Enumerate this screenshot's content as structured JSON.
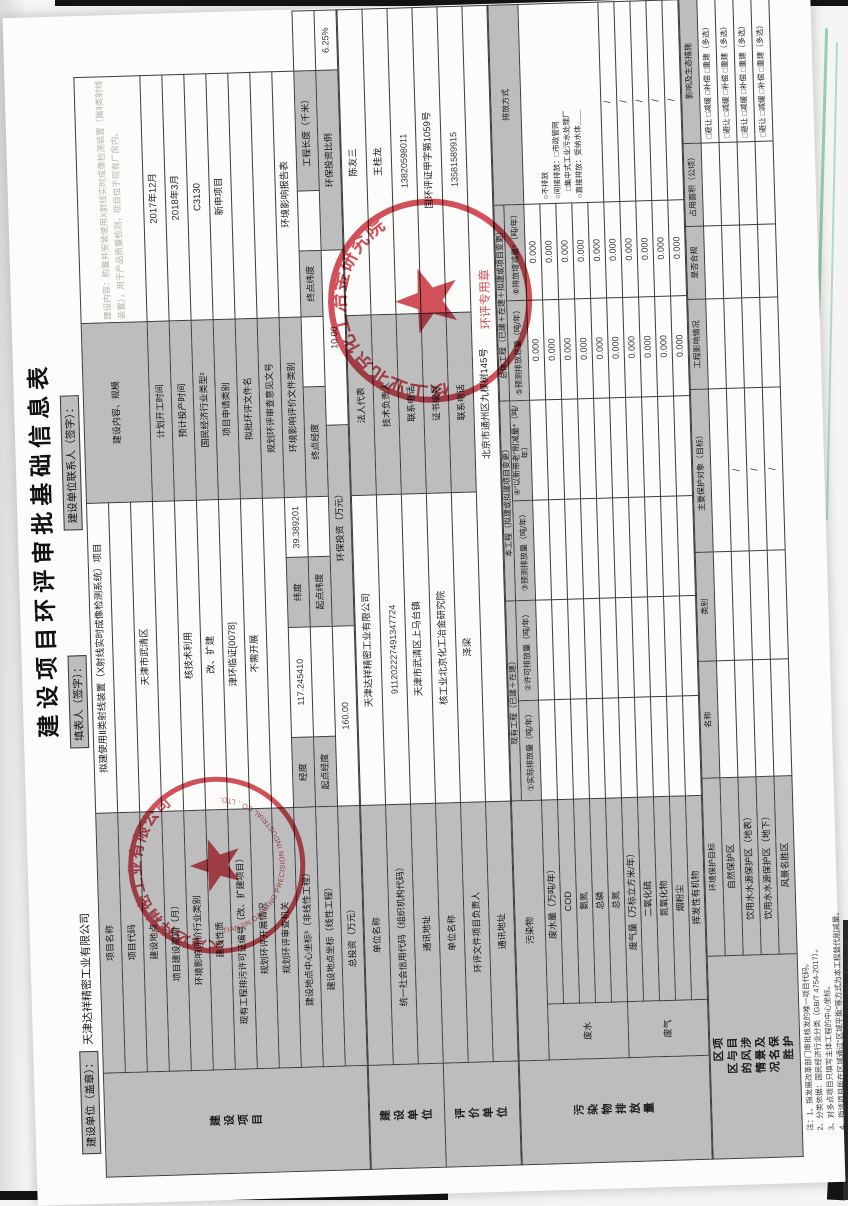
{
  "page": {
    "title": "建设项目环评审批基础信息表"
  },
  "header": {
    "unit_label": "建设单位（盖章）：",
    "unit_value": "天津达祥精密工业有限公司",
    "filler_label": "填表人（签字）：",
    "contact_label": "建设单位联系人（签字）："
  },
  "stamps": {
    "company": {
      "zh": "天津达祥精密工业有限公司",
      "en": "TIANJIN DAXIANG PRECISION INDUSTRIAL CO., LTD."
    },
    "eia": {
      "zh": "核工业北京化工冶金研究院",
      "sub": "环评专用章"
    }
  },
  "notes": {
    "lines": [
      "注：1、指发展改革部门审批核发的唯一项目代码。",
      "2、分类依据：国民经济行业分类（GB/T 4754-2017）。",
      "3、对多点项目只填写主体工程的中心坐标。",
      "4、指该项目所在区域通过“区域平衡”等方式为本工程替代削减量。",
      "5、⑤＝①＋③－④，⑥＝⑤－②；当②＝0时，⑥＝⑤－①。"
    ]
  },
  "tables": {
    "t1": {
      "cols": [
        104,
        260,
        70,
        110,
        70,
        60,
        71,
        39,
        70,
        66,
        60,
        90,
        30,
        60
      ],
      "rows": [
        [
          {
            "t": "建设项目",
            "k": "sec",
            "rs": 12,
            "n": "section-construction-project"
          },
          {
            "t": "项目名称",
            "k": "lab"
          },
          {
            "t": "拟建使用Ⅱ类射线装置（X射线实时成像检测系统）项目",
            "k": "val",
            "cs": 4,
            "n": "project-name-value"
          },
          {
            "t": "建设内容、规模",
            "k": "lab",
            "cs": 3,
            "rs": 3
          },
          {
            "t": "建设内容：购置并安装使用X射线实时成像检测装置（属Ⅱ类射线装置），用于产品质量检测，项目位于现有厂房内。",
            "k": "faint",
            "cs": 4,
            "rs": 3,
            "n": "construction-content-value"
          }
        ],
        [
          {
            "t": "项目代码",
            "k": "lab"
          },
          {
            "t": "",
            "k": "val",
            "cs": 4
          }
        ],
        [
          {
            "t": "建设地点",
            "k": "lab"
          },
          {
            "t": "天津市武清区",
            "k": "val",
            "cs": 4,
            "n": "construction-site-value"
          }
        ],
        [
          {
            "t": "项目建设周期（月）",
            "k": "lab"
          },
          {
            "t": "",
            "k": "val",
            "cs": 4
          },
          {
            "t": "计划开工时间",
            "k": "lab",
            "cs": 3
          },
          {
            "t": "2017年12月",
            "k": "val",
            "cs": 4,
            "n": "planned-start-value"
          }
        ],
        [
          {
            "t": "环境影响评价行业类别",
            "k": "lab"
          },
          {
            "t": "核技术利用",
            "k": "val",
            "cs": 4
          },
          {
            "t": "预计投产时间",
            "k": "lab",
            "cs": 3
          },
          {
            "t": "2018年3月",
            "k": "val",
            "cs": 4,
            "n": "planned-operation-value"
          }
        ],
        [
          {
            "t": "建设性质",
            "k": "lab"
          },
          {
            "t": "改、扩建",
            "k": "val",
            "cs": 4
          },
          {
            "t": "国民经济行业类型²",
            "k": "lab",
            "cs": 3
          },
          {
            "t": "C3130",
            "k": "val",
            "cs": 4,
            "n": "industry-code-value"
          }
        ],
        [
          {
            "t": "现有工程排污许可证编号（改、扩建项目）",
            "k": "lab"
          },
          {
            "t": "津环临证[0078]",
            "k": "val",
            "cs": 4
          },
          {
            "t": "项目申请类别",
            "k": "lab",
            "cs": 3
          },
          {
            "t": "新申项目",
            "k": "val",
            "cs": 4
          }
        ],
        [
          {
            "t": "规划环评开展情况",
            "k": "lab"
          },
          {
            "t": "不需开展",
            "k": "val",
            "cs": 4
          },
          {
            "t": "拟批环评文件名",
            "k": "lab",
            "cs": 3
          },
          {
            "t": "",
            "k": "val",
            "cs": 4
          }
        ],
        [
          {
            "t": "规划环评审查机关",
            "k": "lab"
          },
          {
            "t": "",
            "k": "val",
            "cs": 4
          },
          {
            "t": "规划环评审查意见文号",
            "k": "lab",
            "cs": 3
          },
          {
            "t": "",
            "k": "val",
            "cs": 4
          }
        ],
        [
          {
            "t": "建设地点中心坐标³（非线性工程）",
            "k": "lab"
          },
          {
            "t": "经度",
            "k": "lab"
          },
          {
            "t": "117.245410",
            "k": "num",
            "n": "longitude-value"
          },
          {
            "t": "纬度",
            "k": "lab"
          },
          {
            "t": "39.389201",
            "k": "num",
            "n": "latitude-value"
          },
          {
            "t": "环境影响评价文件类别",
            "k": "lab",
            "cs": 3
          },
          {
            "t": "环境影响报告表",
            "k": "val",
            "cs": 4,
            "n": "eia-doc-type-value"
          }
        ],
        [
          {
            "t": "建设地点坐标（线性工程）",
            "k": "lab"
          },
          {
            "t": "起点经度",
            "k": "lab"
          },
          {
            "t": "",
            "k": "val"
          },
          {
            "t": "起点纬度",
            "k": "lab"
          },
          {
            "t": "",
            "k": "val"
          },
          {
            "t": "终点经度",
            "k": "lab",
            "cs": 2
          },
          {
            "t": "",
            "k": "val"
          },
          {
            "t": "终点纬度",
            "k": "lab"
          },
          {
            "t": "",
            "k": "val"
          },
          {
            "t": "工程长度（千米）",
            "k": "lab",
            "cs": 2
          },
          {
            "t": "",
            "k": "val"
          }
        ],
        [
          {
            "t": "总投资（万元）",
            "k": "lab"
          },
          {
            "t": "160.00",
            "k": "num",
            "cs": 2,
            "n": "total-investment-value"
          },
          {
            "t": "环保投资（万元）",
            "k": "lab",
            "cs": 3
          },
          {
            "t": "10.00",
            "k": "num",
            "cs": 3,
            "n": "env-investment-value"
          },
          {
            "t": "环保投资比例",
            "k": "lab",
            "cs": 3
          },
          {
            "t": "6.25%",
            "k": "num",
            "cs": 2,
            "n": "env-investment-ratio-value"
          }
        ]
      ]
    },
    "t2": {
      "cols": [
        104,
        260,
        310,
        180,
        306
      ],
      "rows": [
        [
          {
            "t": "建设单位",
            "k": "sec",
            "rs": 3,
            "n": "section-construction-unit"
          },
          {
            "t": "单位名称",
            "k": "lab"
          },
          {
            "t": "天津达祥精密工业有限公司",
            "k": "val",
            "n": "builder-name-value"
          },
          {
            "t": "法人代表",
            "k": "lab"
          },
          {
            "t": "陈友三",
            "k": "val",
            "n": "legal-rep-value"
          }
        ],
        [
          {
            "t": "统一社会信用代码（组织机构代码）",
            "k": "lab"
          },
          {
            "t": "911202227491347724",
            "k": "num",
            "n": "credit-code-value"
          },
          {
            "t": "技术负责人",
            "k": "lab"
          },
          {
            "t": "王桂龙",
            "k": "val",
            "n": "tech-lead-value"
          }
        ],
        [
          {
            "t": "通讯地址",
            "k": "lab"
          },
          {
            "t": "天津市武清区上马台镇",
            "k": "val",
            "n": "builder-address-value"
          },
          {
            "t": "联系电话",
            "k": "lab"
          },
          {
            "t": "13820598011",
            "k": "num",
            "n": "builder-phone-value"
          }
        ],
        [
          {
            "t": "评价单位",
            "k": "sec",
            "rs": 3,
            "n": "section-eia-unit"
          },
          {
            "t": "单位名称",
            "k": "lab"
          },
          {
            "t": "核工业北京化工冶金研究院",
            "k": "val",
            "n": "eia-unit-name-value"
          },
          {
            "t": "证书编号",
            "k": "lab"
          },
          {
            "t": "国环评证甲字第1059号",
            "k": "val",
            "n": "eia-cert-value"
          }
        ],
        [
          {
            "t": "环评文件项目负责人",
            "k": "lab"
          },
          {
            "t": "泽梁",
            "k": "val",
            "n": "eia-lead-value"
          },
          {
            "t": "联系电话",
            "k": "lab"
          },
          {
            "t": "13581589915",
            "k": "num",
            "n": "eia-phone-value"
          }
        ],
        [
          {
            "t": "通讯地址",
            "k": "lab"
          },
          {
            "t": "北京市通州区九棵树145号",
            "k": "val",
            "cs": 3,
            "n": "eia-address-value"
          }
        ]
      ]
    },
    "t3": {
      "cols": [
        104,
        56,
        204,
        100,
        100,
        100,
        100,
        100,
        96,
        200
      ],
      "rows": [
        [
          {
            "t": "污染物排放量",
            "k": "sec",
            "rs": 12,
            "n": "section-pollutant-discharge"
          },
          {
            "t": "污染物",
            "k": "lab",
            "cs": 2,
            "rs": 2
          },
          {
            "t": "现有工程（已建＋在建）",
            "k": "hdr",
            "cs": 2
          },
          {
            "t": "本工程（拟建或拟建项目变更）",
            "k": "hdr",
            "cs": 2
          },
          {
            "t": "总体工程（已建＋在建＋拟建或项目变更）",
            "k": "hdr",
            "cs": 2
          },
          {
            "t": "排放方式",
            "k": "hdr",
            "rs": 2
          }
        ],
        [
          {
            "t": "①实际排放量（吨/年）",
            "k": "hdr"
          },
          {
            "t": "②许可排放量（吨/年）",
            "k": "hdr"
          },
          {
            "t": "③预测排放量（吨/年）",
            "k": "hdr"
          },
          {
            "t": "④“以新带老”削减量⁴（吨/年）",
            "k": "hdr"
          },
          {
            "t": "⑤预测排放总量（吨/年）",
            "k": "hdr"
          },
          {
            "t": "⑥排放增减量⁵（吨/年）",
            "k": "hdr"
          }
        ],
        [
          {
            "t": "废水",
            "k": "lab",
            "rs": 5
          },
          {
            "t": "废水量（万吨/年）",
            "k": "lab"
          },
          {
            "t": "",
            "k": "val"
          },
          {
            "t": "",
            "k": "val"
          },
          {
            "t": "",
            "k": "val"
          },
          {
            "t": "",
            "k": "val"
          },
          {
            "t": "0.000",
            "k": "num"
          },
          {
            "t": "0.000",
            "k": "num"
          },
          {
            "t": "○不排放\n○间接排放：□市政管网\n　□集中式工业污水处理厂\n○直接排放：受纳水体＿＿",
            "k": "opt",
            "rs": 5,
            "n": "wastewater-discharge-mode"
          }
        ],
        [
          {
            "t": "COD",
            "k": "lab"
          },
          {
            "t": "",
            "k": "val"
          },
          {
            "t": "",
            "k": "val"
          },
          {
            "t": "",
            "k": "val"
          },
          {
            "t": "",
            "k": "val"
          },
          {
            "t": "0.000",
            "k": "num"
          },
          {
            "t": "0.000",
            "k": "num"
          }
        ],
        [
          {
            "t": "氨氮",
            "k": "lab"
          },
          {
            "t": "",
            "k": "val"
          },
          {
            "t": "",
            "k": "val"
          },
          {
            "t": "",
            "k": "val"
          },
          {
            "t": "",
            "k": "val"
          },
          {
            "t": "0.000",
            "k": "num"
          },
          {
            "t": "0.000",
            "k": "num"
          }
        ],
        [
          {
            "t": "总磷",
            "k": "lab"
          },
          {
            "t": "",
            "k": "val"
          },
          {
            "t": "",
            "k": "val"
          },
          {
            "t": "",
            "k": "val"
          },
          {
            "t": "",
            "k": "val"
          },
          {
            "t": "0.000",
            "k": "num"
          },
          {
            "t": "0.000",
            "k": "num"
          }
        ],
        [
          {
            "t": "总氮",
            "k": "lab"
          },
          {
            "t": "",
            "k": "val"
          },
          {
            "t": "",
            "k": "val"
          },
          {
            "t": "",
            "k": "val"
          },
          {
            "t": "",
            "k": "val"
          },
          {
            "t": "0.000",
            "k": "num"
          },
          {
            "t": "0.000",
            "k": "num"
          }
        ],
        [
          {
            "t": "废气",
            "k": "lab",
            "rs": 5
          },
          {
            "t": "废气量（万标立方米/年）",
            "k": "lab"
          },
          {
            "t": "",
            "k": "val"
          },
          {
            "t": "",
            "k": "val"
          },
          {
            "t": "",
            "k": "val"
          },
          {
            "t": "",
            "k": "val"
          },
          {
            "t": "0.000",
            "k": "num"
          },
          {
            "t": "0.000",
            "k": "num"
          },
          {
            "t": "/",
            "k": "val"
          }
        ],
        [
          {
            "t": "二氧化硫",
            "k": "lab"
          },
          {
            "t": "",
            "k": "val"
          },
          {
            "t": "",
            "k": "val"
          },
          {
            "t": "",
            "k": "val"
          },
          {
            "t": "",
            "k": "val"
          },
          {
            "t": "0.000",
            "k": "num"
          },
          {
            "t": "0.000",
            "k": "num"
          },
          {
            "t": "/",
            "k": "val"
          }
        ],
        [
          {
            "t": "氮氧化物",
            "k": "lab"
          },
          {
            "t": "",
            "k": "val"
          },
          {
            "t": "",
            "k": "val"
          },
          {
            "t": "",
            "k": "val"
          },
          {
            "t": "",
            "k": "val"
          },
          {
            "t": "0.000",
            "k": "num"
          },
          {
            "t": "0.000",
            "k": "num"
          },
          {
            "t": "/",
            "k": "val"
          }
        ],
        [
          {
            "t": "烟粉尘",
            "k": "lab"
          },
          {
            "t": "",
            "k": "val"
          },
          {
            "t": "",
            "k": "val"
          },
          {
            "t": "",
            "k": "val"
          },
          {
            "t": "",
            "k": "val"
          },
          {
            "t": "0.000",
            "k": "num"
          },
          {
            "t": "0.000",
            "k": "num"
          },
          {
            "t": "/",
            "k": "val"
          }
        ],
        [
          {
            "t": "挥发性有机物",
            "k": "lab"
          },
          {
            "t": "",
            "k": "val"
          },
          {
            "t": "",
            "k": "val"
          },
          {
            "t": "",
            "k": "val"
          },
          {
            "t": "",
            "k": "val"
          },
          {
            "t": "0.000",
            "k": "num"
          },
          {
            "t": "0.000",
            "k": "num"
          },
          {
            "t": "/",
            "k": "val"
          }
        ]
      ]
    },
    "t4": {
      "cols": [
        104,
        196,
        130,
        120,
        180,
        100,
        80,
        90,
        160
      ],
      "rows": [
        [
          {
            "t": "项目涉及保护区与风景名胜区的情况",
            "k": "sec",
            "rs": 5,
            "n": "section-protected-areas"
          },
          {
            "t": "环境保护目标",
            "k": "hdr"
          },
          {
            "t": "名称",
            "k": "hdr"
          },
          {
            "t": "类别",
            "k": "hdr"
          },
          {
            "t": "主要保护对象（目标）",
            "k": "hdr"
          },
          {
            "t": "工程影响情况",
            "k": "hdr"
          },
          {
            "t": "是否合规",
            "k": "hdr"
          },
          {
            "t": "占用面积（公顷）",
            "k": "hdr"
          },
          {
            "t": "影响及生态措施",
            "k": "hdr"
          }
        ],
        [
          {
            "t": "自然保护区",
            "k": "lab"
          },
          {
            "t": "",
            "k": "val"
          },
          {
            "t": "",
            "k": "val"
          },
          {
            "t": "",
            "k": "val"
          },
          {
            "t": "",
            "k": "val"
          },
          {
            "t": "",
            "k": "val"
          },
          {
            "t": "",
            "k": "val"
          },
          {
            "t": "□避让 □减缓 □补偿 □重建（多选）",
            "k": "opt"
          }
        ],
        [
          {
            "t": "饮用水水源保护区（地表）",
            "k": "lab"
          },
          {
            "t": "",
            "k": "val"
          },
          {
            "t": "",
            "k": "val"
          },
          {
            "t": "/",
            "k": "val"
          },
          {
            "t": "",
            "k": "val"
          },
          {
            "t": "",
            "k": "val"
          },
          {
            "t": "",
            "k": "val"
          },
          {
            "t": "□避让 □减缓 □补偿 □重建（多选）",
            "k": "opt"
          }
        ],
        [
          {
            "t": "饮用水水源保护区（地下）",
            "k": "lab"
          },
          {
            "t": "",
            "k": "val"
          },
          {
            "t": "",
            "k": "val"
          },
          {
            "t": "/",
            "k": "val"
          },
          {
            "t": "",
            "k": "val"
          },
          {
            "t": "",
            "k": "val"
          },
          {
            "t": "",
            "k": "val"
          },
          {
            "t": "□避让 □减缓 □补偿 □重建（多选）",
            "k": "opt"
          }
        ],
        [
          {
            "t": "风景名胜区",
            "k": "lab"
          },
          {
            "t": "",
            "k": "val"
          },
          {
            "t": "",
            "k": "val"
          },
          {
            "t": "/",
            "k": "val"
          },
          {
            "t": "",
            "k": "val"
          },
          {
            "t": "",
            "k": "val"
          },
          {
            "t": "",
            "k": "val"
          },
          {
            "t": "□避让 □减缓 □补偿 □重建（多选）",
            "k": "opt"
          }
        ]
      ]
    }
  }
}
